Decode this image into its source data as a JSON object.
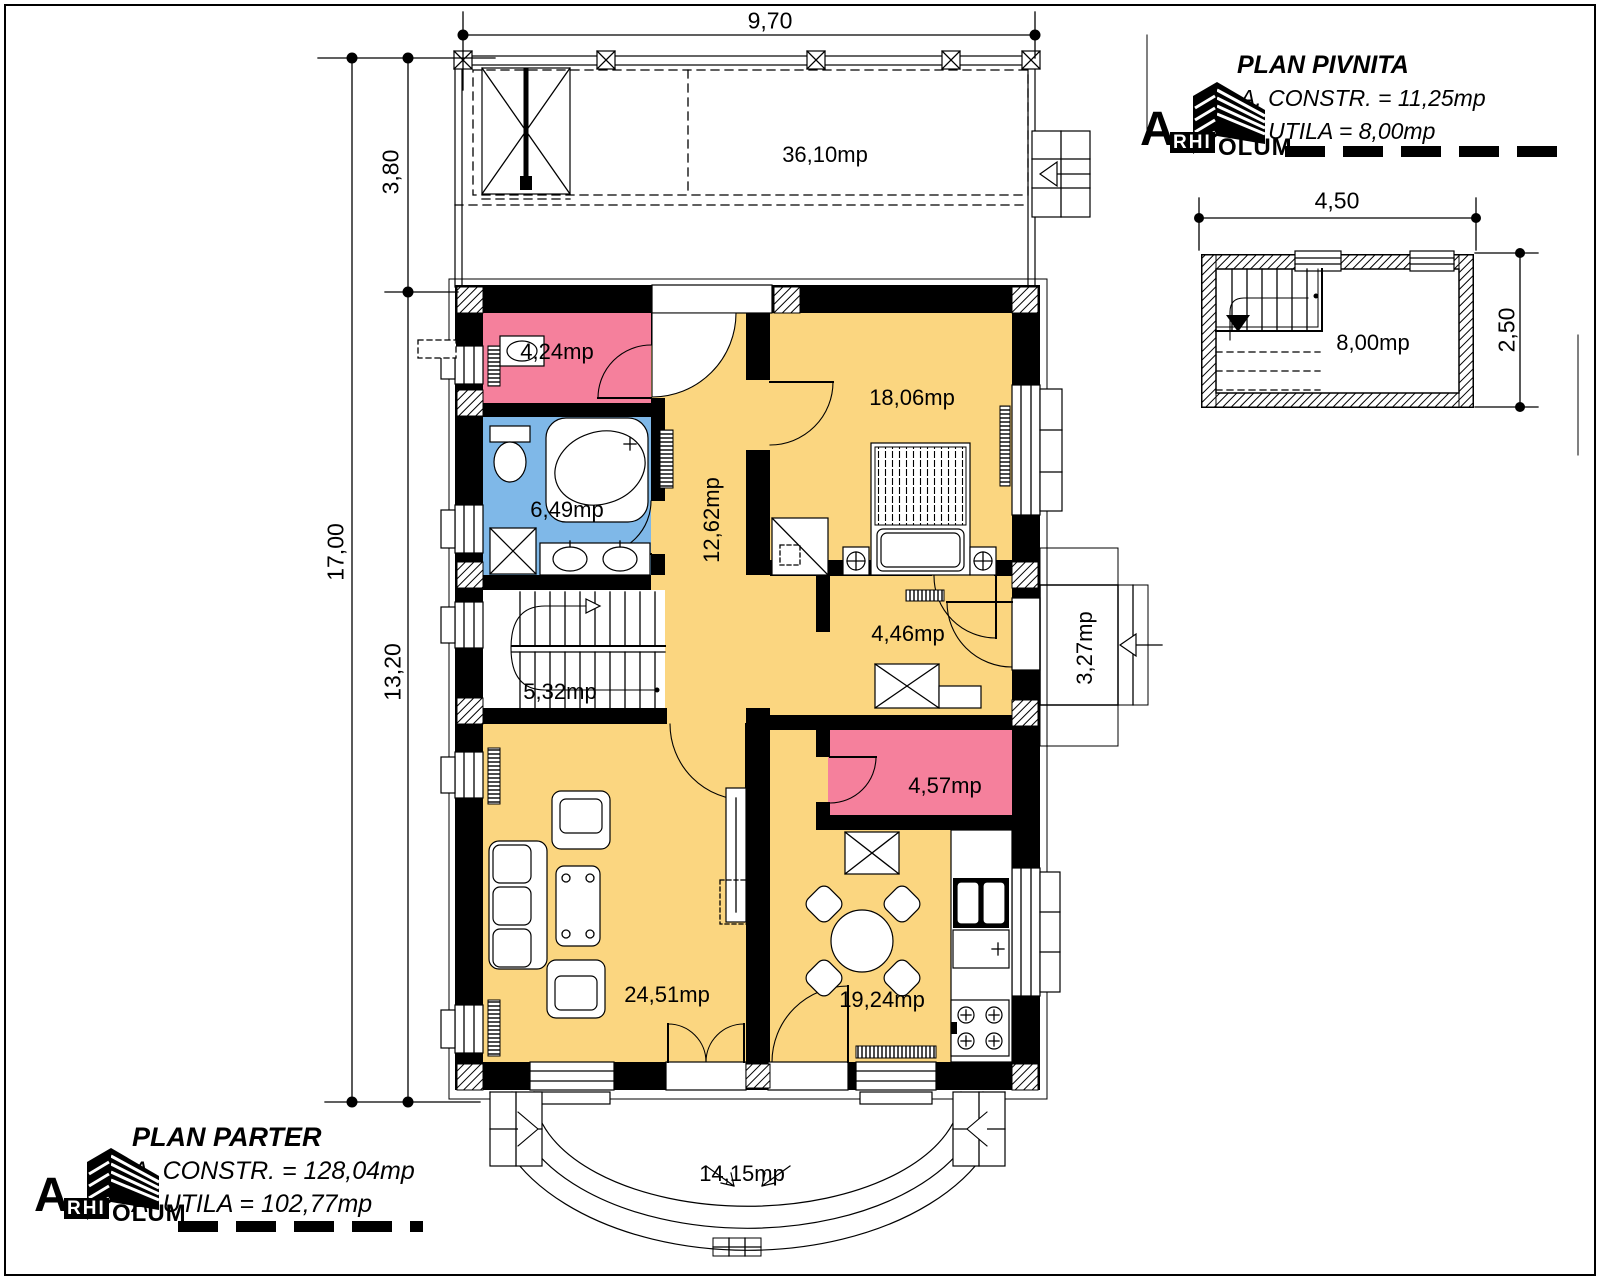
{
  "titles": {
    "pivnita": {
      "title": "PLAN PIVNITA",
      "constr": "A. CONSTR. = 11,25mp",
      "utila": "A. UTILA = 8,00mp"
    },
    "parter": {
      "title": "PLAN PARTER",
      "constr": "A. CONSTR. = 128,04mp",
      "utila": "A. UTILA = 102,77mp"
    }
  },
  "brand": {
    "a": "A",
    "rhi": "RHI",
    "olum": "OLUM"
  },
  "dimensions": {
    "top_width": "9,70",
    "left_total": "17,00",
    "left_upper": "3,80",
    "left_lower": "13,20",
    "basement_width": "4,50",
    "basement_depth": "2,50"
  },
  "rooms": {
    "terrace_top": "36,10mp",
    "wc": "4,24mp",
    "bedroom": "18,06mp",
    "bathroom": "6,49mp",
    "hallway": "12,62mp",
    "stairs": "5,32mp",
    "entry_hall": "4,46mp",
    "porch": "3,27mp",
    "pantry": "4,57mp",
    "living": "24,51mp",
    "kitchen": "19,24mp",
    "terrace_bottom": "14,15mp",
    "basement": "8,00mp"
  },
  "colors": {
    "room_yellow": "#FBD680",
    "room_pink": "#F5809C",
    "room_blue": "#7FB8E8",
    "line_black": "#000000"
  }
}
